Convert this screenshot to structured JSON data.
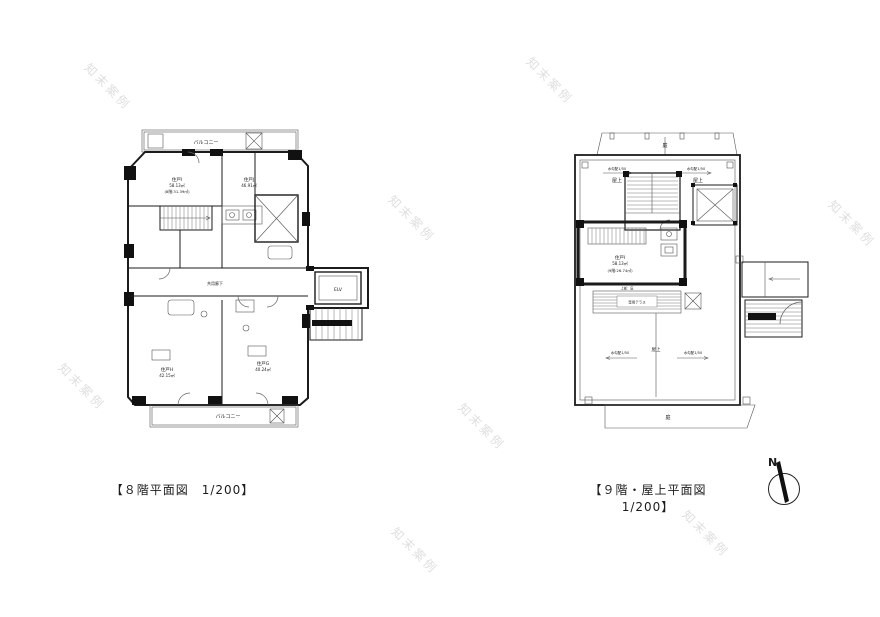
{
  "watermark": {
    "text": "知末案例"
  },
  "floor8": {
    "caption": "【８階平面図　1/200】",
    "balcony_top": "バルコニー",
    "balcony_bottom": "バルコニー",
    "corridor": "共用廊下",
    "elevator": "ELV",
    "unit_i": {
      "name": "住戸I",
      "area": "58.13㎡",
      "note": "(8階:31.39㎡)"
    },
    "unit_j": {
      "name": "住戸J",
      "area": "46.91㎡"
    },
    "unit_h": {
      "name": "住戸H",
      "area": "42.15㎡"
    },
    "unit_g": {
      "name": "住戸G",
      "area": "40.24㎡"
    }
  },
  "floor9": {
    "caption": "【９階・屋上平面図　1/200】",
    "garden_top": "庭",
    "garden_bottom": "庭",
    "roof_top_left": "屋上",
    "roof_top_right": "屋上",
    "roof_center": "屋上",
    "slope_top_left": "水勾配1/50",
    "slope_top_right": "水勾配1/50",
    "slope_bottom_left": "水勾配1/50",
    "slope_bottom_right": "水勾配1/50",
    "unit_i": {
      "name": "住戸I",
      "area": "58.13㎡",
      "note": "(9階:26.74㎡)"
    },
    "canopy": "上部：庇",
    "terrace": "専用テラス"
  },
  "compass": {
    "label": "N"
  }
}
